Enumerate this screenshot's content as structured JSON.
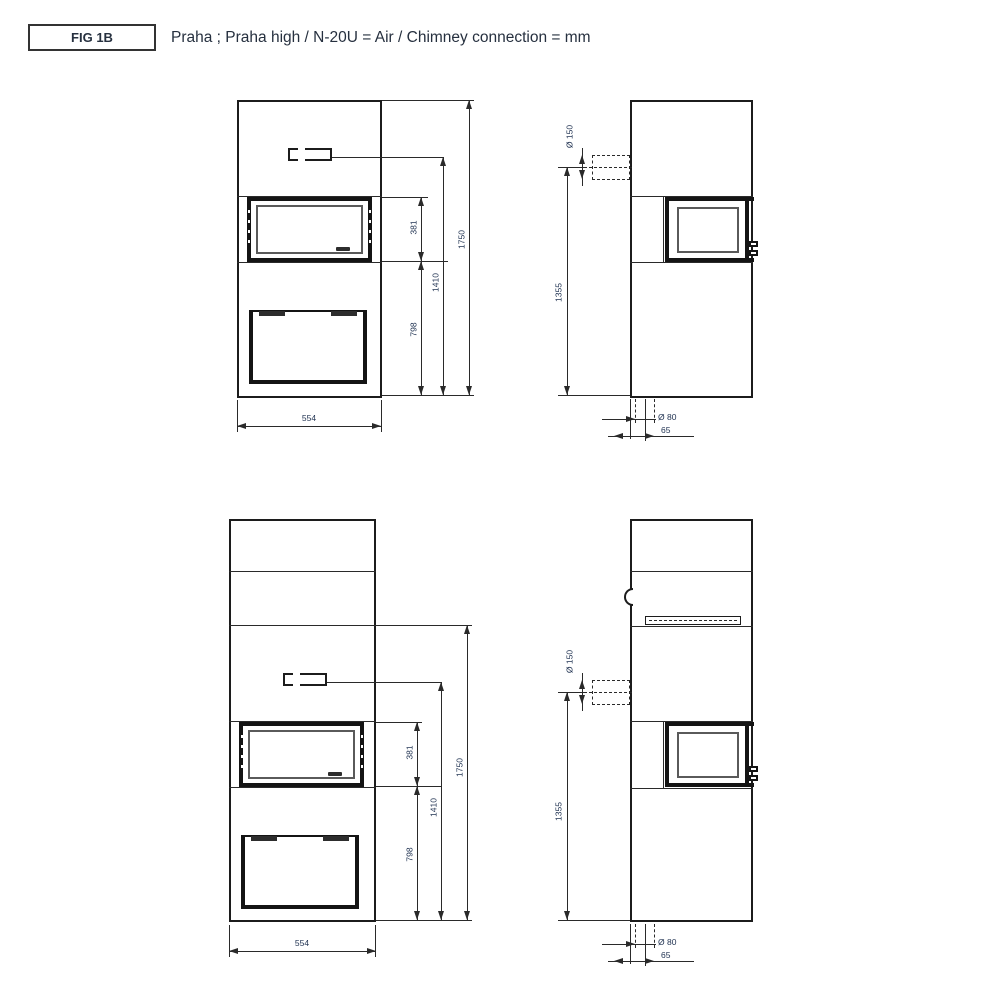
{
  "figure": {
    "label": "FIG 1B",
    "title": "Praha ; Praha high / N-20U = Air / Chimney connection = mm",
    "models": "Praha ; Praha high",
    "units": "mm"
  },
  "dims": {
    "front": {
      "width": "554",
      "glass_height": "381",
      "air_slot_height": "1410",
      "total_height": "1750",
      "firebox_bottom_height": "798"
    },
    "side": {
      "top_flue_diameter": "Ø 150",
      "top_flue_height": "1355",
      "bottom_flue_diameter": "Ø 80",
      "bottom_flue_offset": "65"
    }
  },
  "colors": {
    "background": "#ffffff",
    "drawing_line": "#1c1c1c",
    "dimension_line": "#2a2a2a",
    "dimension_text": "#223453",
    "title_text": "#26303f"
  }
}
